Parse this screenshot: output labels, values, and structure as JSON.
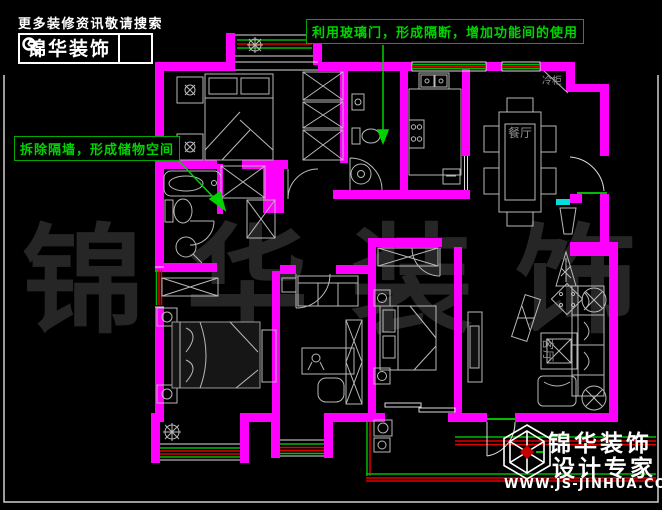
{
  "header": {
    "tagline": "更多装修资讯敬请搜索",
    "brand": "锦华装饰"
  },
  "annotations": {
    "glass_door": "利用玻璃门，形成隔断，增加功能间的使用",
    "demolish_wall": "拆除隔墙，形成储物空间"
  },
  "plan": {
    "labels": {
      "dining": "餐厅",
      "living": "客厅",
      "freezer": "冷柜"
    },
    "colors": {
      "background": "#000000",
      "wall": "#ff00ff",
      "furniture_line": "#b9b9b9",
      "annotation_green": "#00d400",
      "window_red": "#e00000",
      "window_green": "#00bb00",
      "threshold_cyan": "#00dddd",
      "label_gray": "#8f8f8f",
      "watermark_gray": "#262626"
    }
  },
  "watermark": {
    "text": "锦 华 装 饰"
  },
  "footer": {
    "brand": "锦华装饰",
    "slogan": "设计专家",
    "url": "WWW.JS-JINHUA.COM"
  }
}
